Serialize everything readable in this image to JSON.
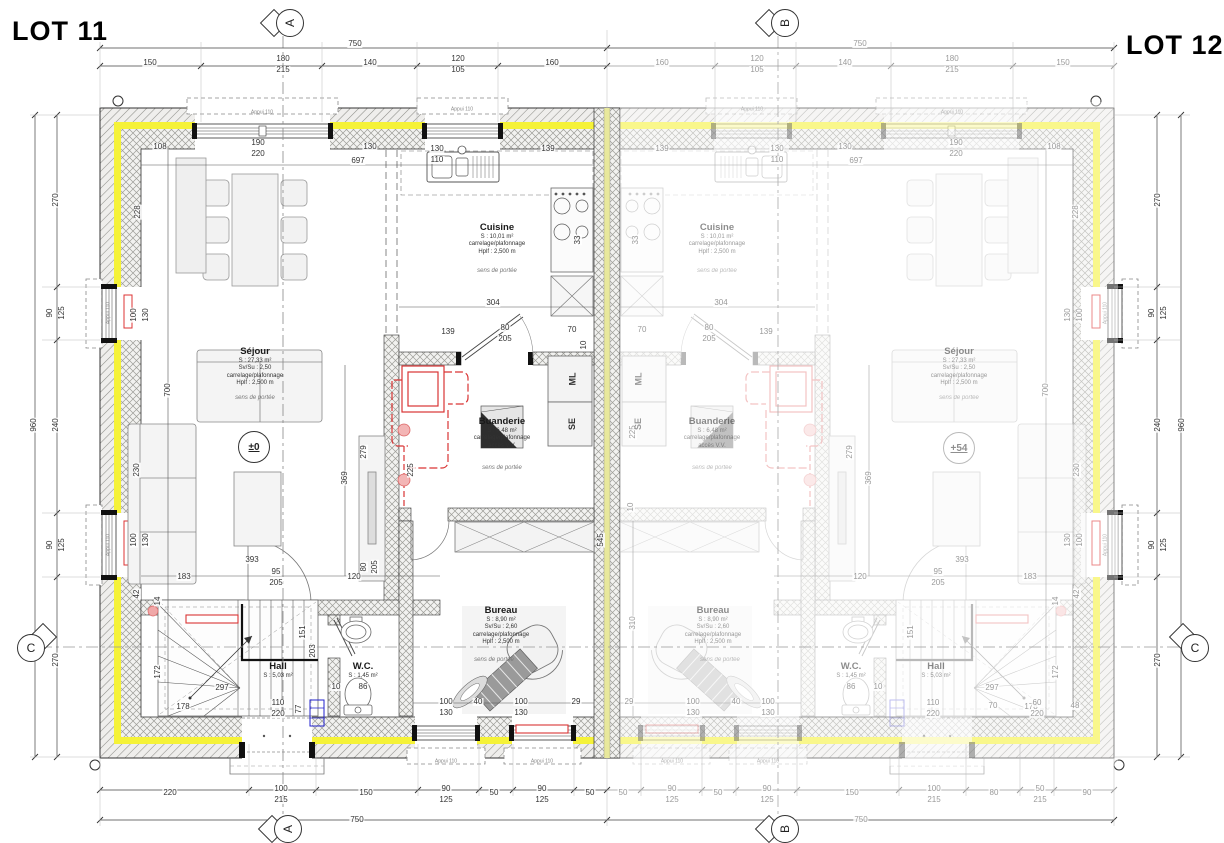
{
  "lots": {
    "left": "LOT 11",
    "right": "LOT 12"
  },
  "section_markers": {
    "a": "A",
    "b": "B",
    "c": "C"
  },
  "levels": {
    "lot11": "±0",
    "lot12": "+54"
  },
  "rooms": {
    "sejour": {
      "name": "Séjour",
      "area": "S : 27,33 m²",
      "ratio": "Sv/Su : 2,50",
      "finish": "carrelage/plafonnage",
      "height": "Hplf : 2,500 m"
    },
    "cuisine": {
      "name": "Cuisine",
      "area": "S : 10,01 m²",
      "finish": "carrelage/plafonnage",
      "height": "Hplf : 2,500 m"
    },
    "buanderie": {
      "name": "Buanderie",
      "area": "S : 6,48 m²",
      "finish": "carrelage/plafonnage",
      "height": "Hplf : 2,500 m",
      "access": "accès V.V."
    },
    "bureau": {
      "name": "Bureau",
      "area": "S : 8,90 m²",
      "ratio": "Sv/Su : 2,60",
      "finish": "carrelage/plafonnage",
      "height": "Hplf : 2,500 m"
    },
    "hall": {
      "name": "Hall",
      "area": "S : 5,03 m²"
    },
    "wc": {
      "name": "W.C.",
      "area": "S : 1,45 m²"
    }
  },
  "notes": {
    "span_direction": "sens de portée",
    "window_sill": "Appui 110"
  },
  "appliances": {
    "washing_machine": "ML",
    "dryer": "SE"
  },
  "colors": {
    "insulation_yellow": "#f5f238",
    "party_wall_yellow": "#e8e89c",
    "pipe_red": "#d93434"
  },
  "dim_labels": [
    {
      "t": "750",
      "x": 355,
      "y": 44
    },
    {
      "t": "150",
      "x": 150,
      "y": 63
    },
    {
      "t": "180",
      "x": 283,
      "y": 59
    },
    {
      "t": "215",
      "x": 283,
      "y": 70
    },
    {
      "t": "140",
      "x": 370,
      "y": 63
    },
    {
      "t": "120",
      "x": 458,
      "y": 59
    },
    {
      "t": "105",
      "x": 458,
      "y": 70
    },
    {
      "t": "160",
      "x": 552,
      "y": 63
    },
    {
      "t": "750",
      "x": 860,
      "y": 44,
      "c": "g"
    },
    {
      "t": "160",
      "x": 662,
      "y": 63,
      "c": "g"
    },
    {
      "t": "120",
      "x": 757,
      "y": 59,
      "c": "g"
    },
    {
      "t": "105",
      "x": 757,
      "y": 70,
      "c": "g"
    },
    {
      "t": "140",
      "x": 845,
      "y": 63,
      "c": "g"
    },
    {
      "t": "180",
      "x": 952,
      "y": 59,
      "c": "g"
    },
    {
      "t": "215",
      "x": 952,
      "y": 70,
      "c": "g"
    },
    {
      "t": "150",
      "x": 1063,
      "y": 63,
      "c": "g"
    },
    {
      "t": "220",
      "x": 170,
      "y": 793
    },
    {
      "t": "100",
      "x": 281,
      "y": 789
    },
    {
      "t": "215",
      "x": 281,
      "y": 800
    },
    {
      "t": "150",
      "x": 366,
      "y": 793
    },
    {
      "t": "90",
      "x": 446,
      "y": 789
    },
    {
      "t": "125",
      "x": 446,
      "y": 800
    },
    {
      "t": "50",
      "x": 494,
      "y": 793
    },
    {
      "t": "90",
      "x": 542,
      "y": 789
    },
    {
      "t": "125",
      "x": 542,
      "y": 800
    },
    {
      "t": "50",
      "x": 590,
      "y": 793
    },
    {
      "t": "750",
      "x": 357,
      "y": 820
    },
    {
      "t": "50",
      "x": 623,
      "y": 793,
      "c": "g"
    },
    {
      "t": "90",
      "x": 672,
      "y": 789,
      "c": "g"
    },
    {
      "t": "125",
      "x": 672,
      "y": 800,
      "c": "g"
    },
    {
      "t": "50",
      "x": 718,
      "y": 793,
      "c": "g"
    },
    {
      "t": "90",
      "x": 767,
      "y": 789,
      "c": "g"
    },
    {
      "t": "125",
      "x": 767,
      "y": 800,
      "c": "g"
    },
    {
      "t": "150",
      "x": 852,
      "y": 793,
      "c": "g"
    },
    {
      "t": "100",
      "x": 934,
      "y": 789,
      "c": "g"
    },
    {
      "t": "215",
      "x": 934,
      "y": 800,
      "c": "g"
    },
    {
      "t": "80",
      "x": 994,
      "y": 793,
      "c": "g"
    },
    {
      "t": "50",
      "x": 1040,
      "y": 789,
      "c": "g"
    },
    {
      "t": "215",
      "x": 1040,
      "y": 800,
      "c": "g"
    },
    {
      "t": "90",
      "x": 1087,
      "y": 793,
      "c": "g"
    },
    {
      "t": "750",
      "x": 861,
      "y": 820,
      "c": "g"
    },
    {
      "t": "270",
      "x": 56,
      "y": 200,
      "r": -90
    },
    {
      "t": "90",
      "x": 50,
      "y": 313,
      "r": -90
    },
    {
      "t": "125",
      "x": 62,
      "y": 313,
      "r": -90
    },
    {
      "t": "240",
      "x": 56,
      "y": 425,
      "r": -90
    },
    {
      "t": "960",
      "x": 34,
      "y": 425,
      "r": -90
    },
    {
      "t": "90",
      "x": 50,
      "y": 545,
      "r": -90
    },
    {
      "t": "125",
      "x": 62,
      "y": 545,
      "r": -90
    },
    {
      "t": "270",
      "x": 56,
      "y": 660,
      "r": -90
    },
    {
      "t": "270",
      "x": 1158,
      "y": 200,
      "r": -90
    },
    {
      "t": "90",
      "x": 1152,
      "y": 313,
      "r": -90
    },
    {
      "t": "125",
      "x": 1164,
      "y": 313,
      "r": -90
    },
    {
      "t": "240",
      "x": 1158,
      "y": 425,
      "r": -90
    },
    {
      "t": "960",
      "x": 1182,
      "y": 425,
      "r": -90
    },
    {
      "t": "90",
      "x": 1152,
      "y": 545,
      "r": -90
    },
    {
      "t": "125",
      "x": 1164,
      "y": 545,
      "r": -90
    },
    {
      "t": "270",
      "x": 1158,
      "y": 660,
      "r": -90
    },
    {
      "t": "108",
      "x": 160,
      "y": 147
    },
    {
      "t": "190",
      "x": 258,
      "y": 143
    },
    {
      "t": "220",
      "x": 258,
      "y": 154
    },
    {
      "t": "130",
      "x": 370,
      "y": 147
    },
    {
      "t": "697",
      "x": 358,
      "y": 161
    },
    {
      "t": "130",
      "x": 437,
      "y": 149
    },
    {
      "t": "110",
      "x": 437,
      "y": 160
    },
    {
      "t": "139",
      "x": 548,
      "y": 149
    },
    {
      "t": "228",
      "x": 138,
      "y": 212,
      "r": -90
    },
    {
      "t": "100",
      "x": 134,
      "y": 315,
      "r": -90
    },
    {
      "t": "130",
      "x": 146,
      "y": 315,
      "r": -90
    },
    {
      "t": "700",
      "x": 168,
      "y": 390,
      "r": -90
    },
    {
      "t": "230",
      "x": 137,
      "y": 470,
      "r": -90
    },
    {
      "t": "100",
      "x": 134,
      "y": 540,
      "r": -90
    },
    {
      "t": "130",
      "x": 146,
      "y": 540,
      "r": -90
    },
    {
      "t": "42",
      "x": 137,
      "y": 594,
      "r": -90
    },
    {
      "t": "14",
      "x": 158,
      "y": 601,
      "r": -90
    },
    {
      "t": "304",
      "x": 493,
      "y": 303
    },
    {
      "t": "33",
      "x": 578,
      "y": 240,
      "r": -90
    },
    {
      "t": "139",
      "x": 448,
      "y": 332
    },
    {
      "t": "80",
      "x": 505,
      "y": 328
    },
    {
      "t": "205",
      "x": 505,
      "y": 339
    },
    {
      "t": "70",
      "x": 572,
      "y": 330
    },
    {
      "t": "10",
      "x": 584,
      "y": 345,
      "r": -90
    },
    {
      "t": "545",
      "x": 601,
      "y": 540,
      "r": -90
    },
    {
      "t": "225",
      "x": 411,
      "y": 470,
      "r": -90
    },
    {
      "t": "369",
      "x": 345,
      "y": 478,
      "r": -90
    },
    {
      "t": "279",
      "x": 364,
      "y": 452,
      "r": -90
    },
    {
      "t": "393",
      "x": 252,
      "y": 560
    },
    {
      "t": "183",
      "x": 184,
      "y": 577
    },
    {
      "t": "95",
      "x": 276,
      "y": 572
    },
    {
      "t": "205",
      "x": 276,
      "y": 583
    },
    {
      "t": "120",
      "x": 354,
      "y": 577
    },
    {
      "t": "80",
      "x": 364,
      "y": 567,
      "r": -90
    },
    {
      "t": "205",
      "x": 375,
      "y": 567,
      "r": -90
    },
    {
      "t": "172",
      "x": 158,
      "y": 672,
      "r": -90
    },
    {
      "t": "297",
      "x": 222,
      "y": 688
    },
    {
      "t": "178",
      "x": 183,
      "y": 707
    },
    {
      "t": "110",
      "x": 278,
      "y": 703
    },
    {
      "t": "220",
      "x": 278,
      "y": 714
    },
    {
      "t": "77",
      "x": 299,
      "y": 709,
      "r": -90
    },
    {
      "t": "151",
      "x": 303,
      "y": 632,
      "r": -90
    },
    {
      "t": "203",
      "x": 313,
      "y": 651,
      "r": -90
    },
    {
      "t": "10",
      "x": 336,
      "y": 687
    },
    {
      "t": "86",
      "x": 363,
      "y": 687
    },
    {
      "t": "100",
      "x": 446,
      "y": 702
    },
    {
      "t": "130",
      "x": 446,
      "y": 713
    },
    {
      "t": "40",
      "x": 478,
      "y": 702
    },
    {
      "t": "100",
      "x": 521,
      "y": 702
    },
    {
      "t": "130",
      "x": 521,
      "y": 713
    },
    {
      "t": "29",
      "x": 576,
      "y": 702
    },
    {
      "t": "29",
      "x": 629,
      "y": 702,
      "c": "g"
    },
    {
      "t": "310",
      "x": 633,
      "y": 623,
      "r": -90,
      "c": "g"
    },
    {
      "t": "225",
      "x": 633,
      "y": 432,
      "r": -90,
      "c": "g"
    },
    {
      "t": "10",
      "x": 631,
      "y": 507,
      "r": -90,
      "c": "g"
    },
    {
      "t": "108",
      "x": 1054,
      "y": 147,
      "c": "g"
    },
    {
      "t": "190",
      "x": 956,
      "y": 143,
      "c": "g"
    },
    {
      "t": "220",
      "x": 956,
      "y": 154,
      "c": "g"
    },
    {
      "t": "130",
      "x": 845,
      "y": 147,
      "c": "g"
    },
    {
      "t": "697",
      "x": 856,
      "y": 161,
      "c": "g"
    },
    {
      "t": "130",
      "x": 777,
      "y": 149,
      "c": "g"
    },
    {
      "t": "110",
      "x": 777,
      "y": 160,
      "c": "g"
    },
    {
      "t": "139",
      "x": 662,
      "y": 149,
      "c": "g"
    },
    {
      "t": "228",
      "x": 1076,
      "y": 212,
      "r": -90,
      "c": "g"
    },
    {
      "t": "100",
      "x": 1080,
      "y": 315,
      "r": -90,
      "c": "g"
    },
    {
      "t": "130",
      "x": 1068,
      "y": 315,
      "r": -90,
      "c": "g"
    },
    {
      "t": "700",
      "x": 1046,
      "y": 390,
      "r": -90,
      "c": "g"
    },
    {
      "t": "230",
      "x": 1077,
      "y": 470,
      "r": -90,
      "c": "g"
    },
    {
      "t": "100",
      "x": 1080,
      "y": 540,
      "r": -90,
      "c": "g"
    },
    {
      "t": "130",
      "x": 1068,
      "y": 540,
      "r": -90,
      "c": "g"
    },
    {
      "t": "42",
      "x": 1077,
      "y": 594,
      "r": -90,
      "c": "g"
    },
    {
      "t": "14",
      "x": 1056,
      "y": 601,
      "r": -90,
      "c": "g"
    },
    {
      "t": "304",
      "x": 721,
      "y": 303,
      "c": "g"
    },
    {
      "t": "33",
      "x": 636,
      "y": 240,
      "r": -90,
      "c": "g"
    },
    {
      "t": "139",
      "x": 766,
      "y": 332,
      "c": "g"
    },
    {
      "t": "80",
      "x": 709,
      "y": 328,
      "c": "g"
    },
    {
      "t": "205",
      "x": 709,
      "y": 339,
      "c": "g"
    },
    {
      "t": "70",
      "x": 642,
      "y": 330,
      "c": "g"
    },
    {
      "t": "369",
      "x": 869,
      "y": 478,
      "r": -90,
      "c": "g"
    },
    {
      "t": "279",
      "x": 850,
      "y": 452,
      "r": -90,
      "c": "g"
    },
    {
      "t": "393",
      "x": 962,
      "y": 560,
      "c": "g"
    },
    {
      "t": "183",
      "x": 1030,
      "y": 577,
      "c": "g"
    },
    {
      "t": "95",
      "x": 938,
      "y": 572,
      "c": "g"
    },
    {
      "t": "205",
      "x": 938,
      "y": 583,
      "c": "g"
    },
    {
      "t": "120",
      "x": 860,
      "y": 577,
      "c": "g"
    },
    {
      "t": "297",
      "x": 992,
      "y": 688,
      "c": "g"
    },
    {
      "t": "178",
      "x": 1031,
      "y": 707,
      "c": "g"
    },
    {
      "t": "172",
      "x": 1056,
      "y": 672,
      "r": -90,
      "c": "g"
    },
    {
      "t": "110",
      "x": 933,
      "y": 703,
      "c": "g"
    },
    {
      "t": "220",
      "x": 933,
      "y": 714,
      "c": "g"
    },
    {
      "t": "70",
      "x": 993,
      "y": 706,
      "c": "g"
    },
    {
      "t": "60",
      "x": 1037,
      "y": 703,
      "c": "g"
    },
    {
      "t": "220",
      "x": 1037,
      "y": 714,
      "c": "g"
    },
    {
      "t": "48",
      "x": 1075,
      "y": 706,
      "c": "g"
    },
    {
      "t": "10",
      "x": 878,
      "y": 687,
      "c": "g"
    },
    {
      "t": "86",
      "x": 851,
      "y": 687,
      "c": "g"
    },
    {
      "t": "151",
      "x": 911,
      "y": 632,
      "r": -90,
      "c": "g"
    },
    {
      "t": "100",
      "x": 768,
      "y": 702,
      "c": "g"
    },
    {
      "t": "130",
      "x": 768,
      "y": 713,
      "c": "g"
    },
    {
      "t": "40",
      "x": 736,
      "y": 702,
      "c": "g"
    },
    {
      "t": "100",
      "x": 693,
      "y": 702,
      "c": "g"
    },
    {
      "t": "130",
      "x": 693,
      "y": 713,
      "c": "g"
    },
    {
      "t": "Appui 110",
      "x": 262,
      "y": 113,
      "c": "tiny"
    },
    {
      "t": "Appui 110",
      "x": 462,
      "y": 110,
      "c": "tiny"
    },
    {
      "t": "Appui 110",
      "x": 952,
      "y": 113,
      "c": "tiny g"
    },
    {
      "t": "Appui 110",
      "x": 752,
      "y": 110,
      "c": "tiny g"
    },
    {
      "t": "Appui 110",
      "x": 446,
      "y": 762,
      "c": "tiny"
    },
    {
      "t": "Appui 110",
      "x": 542,
      "y": 762,
      "c": "tiny"
    },
    {
      "t": "Appui 110",
      "x": 672,
      "y": 762,
      "c": "tiny g"
    },
    {
      "t": "Appui 110",
      "x": 768,
      "y": 762,
      "c": "tiny g"
    },
    {
      "t": "Appui 110",
      "x": 109,
      "y": 313,
      "r": -90,
      "c": "tiny"
    },
    {
      "t": "Appui 110",
      "x": 109,
      "y": 545,
      "r": -90,
      "c": "tiny"
    },
    {
      "t": "Appui 110",
      "x": 1106,
      "y": 313,
      "r": -90,
      "c": "tiny g"
    },
    {
      "t": "Appui 110",
      "x": 1106,
      "y": 545,
      "r": -90,
      "c": "tiny g"
    }
  ]
}
